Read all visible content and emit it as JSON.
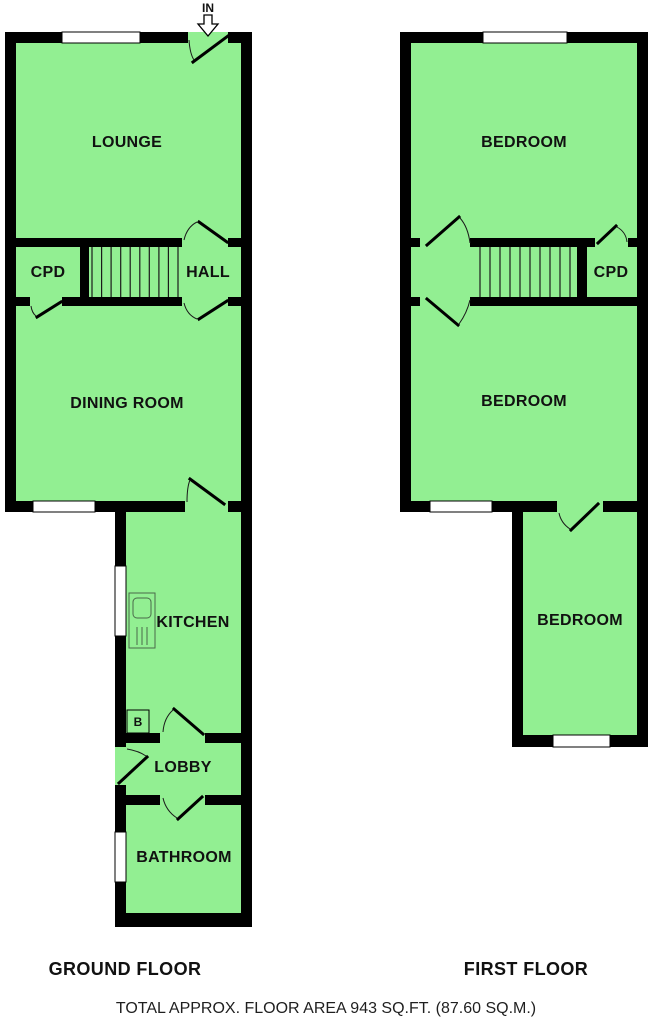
{
  "entrance": {
    "label": "IN"
  },
  "ground_floor": {
    "title": "GROUND FLOOR",
    "rooms": {
      "lounge": "LOUNGE",
      "cpd": "CPD",
      "hall": "HALL",
      "dining_room": "DINING ROOM",
      "kitchen": "KITCHEN",
      "lobby": "LOBBY",
      "bathroom": "BATHROOM"
    },
    "boiler_label": "B"
  },
  "first_floor": {
    "title": "FIRST FLOOR",
    "rooms": {
      "bedroom_front": "BEDROOM",
      "cpd": "CPD",
      "bedroom_middle": "BEDROOM",
      "bedroom_rear": "BEDROOM"
    }
  },
  "footer": {
    "area_text": "TOTAL APPROX. FLOOR AREA 943 SQ.FT. (87.60 SQ.M.)"
  },
  "colors": {
    "room_fill": "#92EF92",
    "wall": "#000000",
    "label_text": "#111111"
  }
}
